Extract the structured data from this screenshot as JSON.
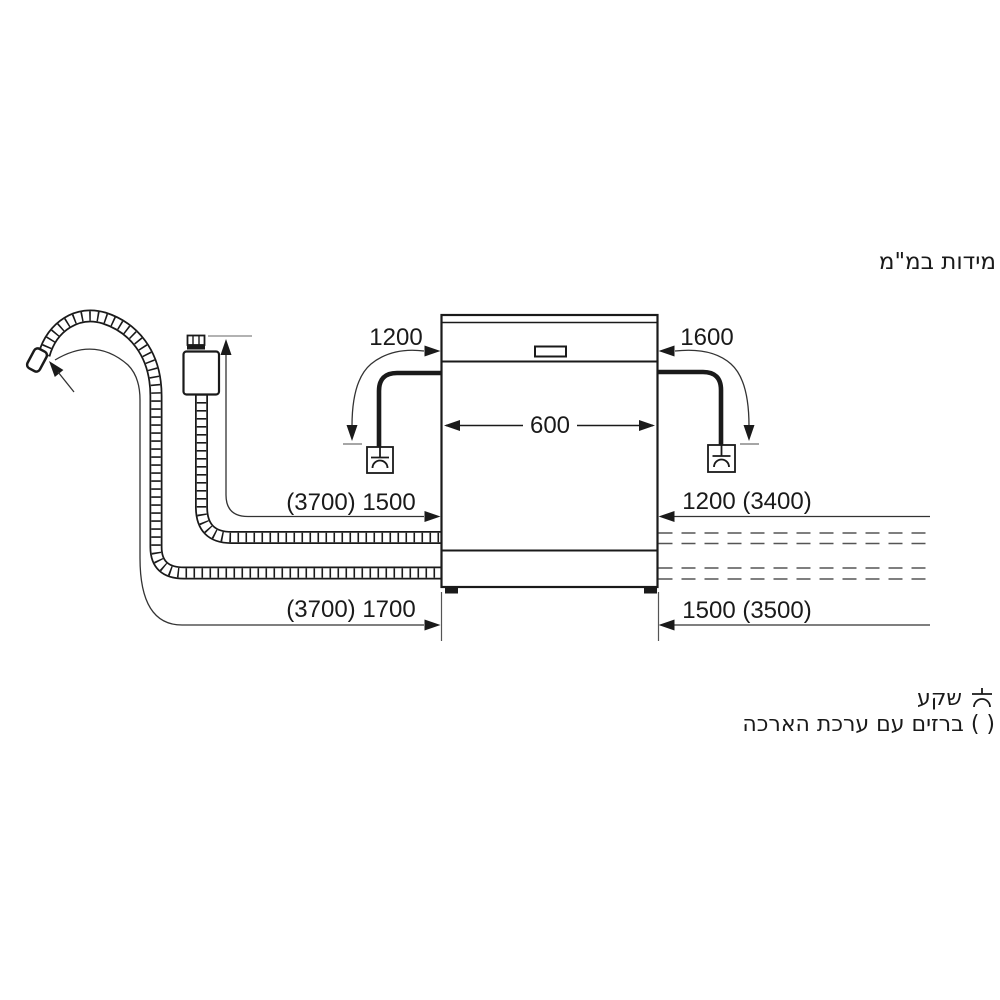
{
  "title": "מידות במ\"מ",
  "dimensions": {
    "cabinet_width": "600",
    "left_cord": "1200",
    "right_cord": "1600",
    "left_supply": "(3700) 1500",
    "right_supply": "1200 (3400)",
    "left_drain": "(3700) 1700",
    "right_drain": "1500 (3500)"
  },
  "legend": {
    "socket_label": "שקע",
    "paren_symbol": "( )",
    "paren_label": "ברזים עם ערכת הארכה"
  },
  "colors": {
    "line": "#1a1a1a",
    "muted": "#888888",
    "background": "#ffffff"
  }
}
